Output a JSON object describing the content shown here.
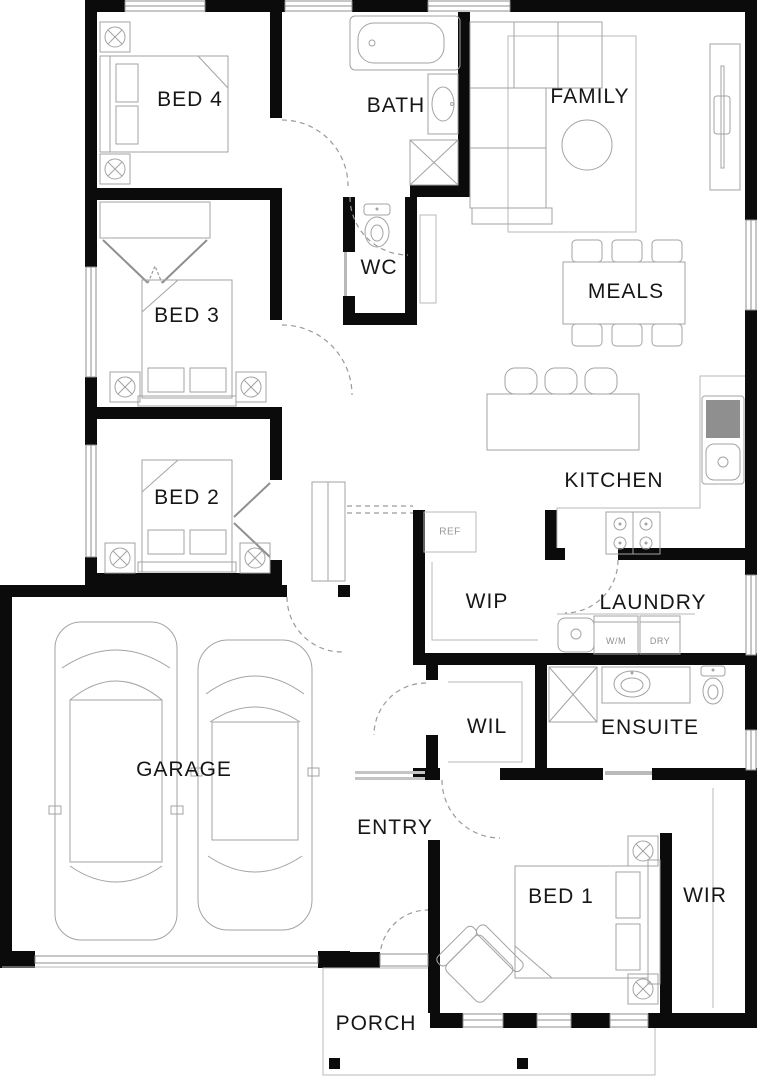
{
  "plan_title": "Single storey house floor plan",
  "labels": {
    "bed4": "BED 4",
    "bath": "BATH",
    "family": "FAMILY",
    "wc": "WC",
    "meals": "MEALS",
    "bed3": "BED 3",
    "kitchen": "KITCHEN",
    "bed2": "BED 2",
    "wip": "WIP",
    "laundry": "LAUNDRY",
    "wil": "WIL",
    "ensuite": "ENSUITE",
    "garage": "GARAGE",
    "entry": "ENTRY",
    "bed1": "BED 1",
    "wir": "WIR",
    "porch": "PORCH"
  },
  "appliances": {
    "fridge": "REF",
    "washing_machine": "W/M",
    "dryer": "DRY"
  },
  "colors": {
    "wall": "#0b0b0b",
    "furniture_outline": "#a3a3a3",
    "label_text": "#161616",
    "minor_label_text": "#979797",
    "background": "#ffffff"
  }
}
